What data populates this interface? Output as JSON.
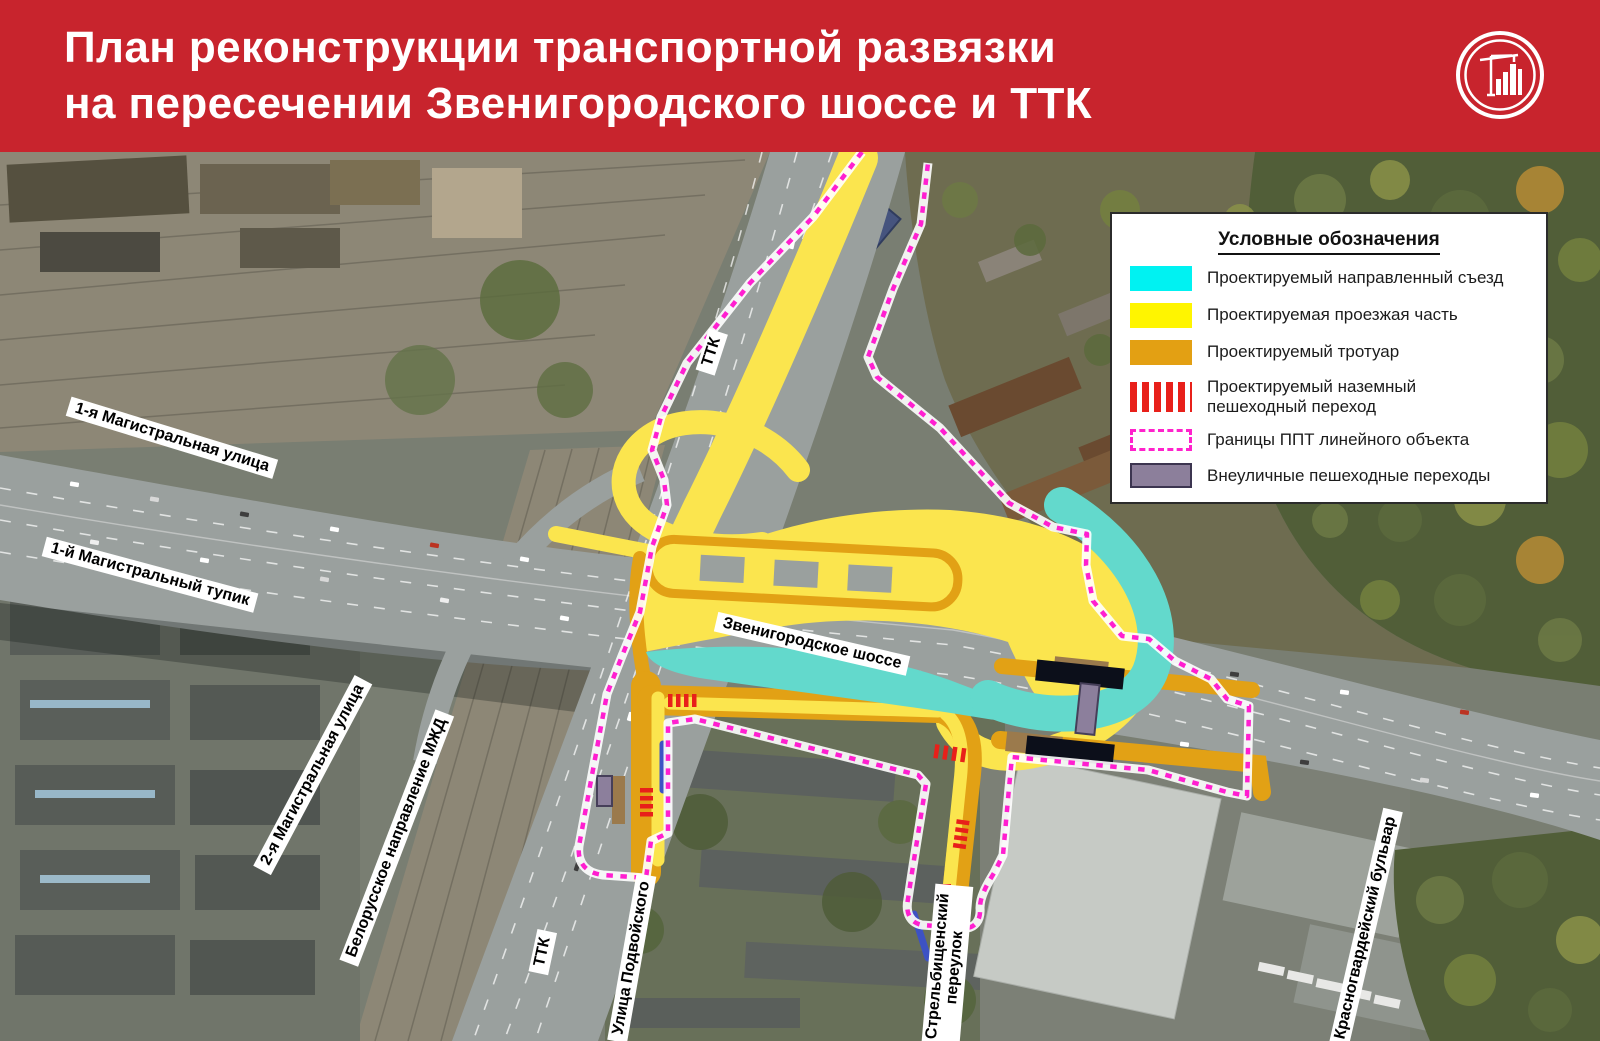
{
  "header": {
    "title_line1": "План реконструкции транспортной развязки",
    "title_line2": "на пересечении Звенигородского шоссе и ТТК",
    "background_color": "#C8242D",
    "logo_name": "construction-crane-buildings-emblem"
  },
  "legend": {
    "title": "Условные обозначения",
    "items": [
      {
        "label": "Проектируемый направленный съезд",
        "color": "#00F2F2",
        "swatch": "solid-cyan"
      },
      {
        "label": "Проектируемая проезжая часть",
        "color": "#FFF500",
        "swatch": "solid-yellow"
      },
      {
        "label": "Проектируемый тротуар",
        "color": "#E3A013",
        "swatch": "solid-orange"
      },
      {
        "label": "Проектируемый наземный пешеходный переход",
        "color": "#E8201A",
        "swatch": "red-stripes"
      },
      {
        "label": "Границы ППТ линейного объекта",
        "color": "#FF22CC",
        "swatch": "magenta-dashed-outline"
      },
      {
        "label": "Внеуличные пешеходные переходы",
        "color": "#8C7F9B",
        "swatch": "purple-bordered"
      }
    ]
  },
  "map_labels": [
    {
      "text": "1-я Магистральная улица"
    },
    {
      "text": "1-й Магистральный тупик"
    },
    {
      "text": "2-я Магистральная улица"
    },
    {
      "text": "Белорусское направление МЖД"
    },
    {
      "text": "ТТК"
    },
    {
      "text": "Звенигородское шоссе"
    },
    {
      "text": "ТТК"
    },
    {
      "text": "Улица Подвойского"
    },
    {
      "lines": [
        "Стрельбищенский",
        "переулок"
      ]
    },
    {
      "text": "Красногвардейский бульвар"
    }
  ],
  "map_overlay_colors": {
    "projected_ramp": "#63D9CC",
    "projected_carriageway": "#FBE54E",
    "projected_sidewalk": "#E2A115",
    "crosswalk": "#E8201A",
    "ppt_boundary": "#FF1FD0",
    "offstreet_crossing": "#8C7F9C"
  }
}
